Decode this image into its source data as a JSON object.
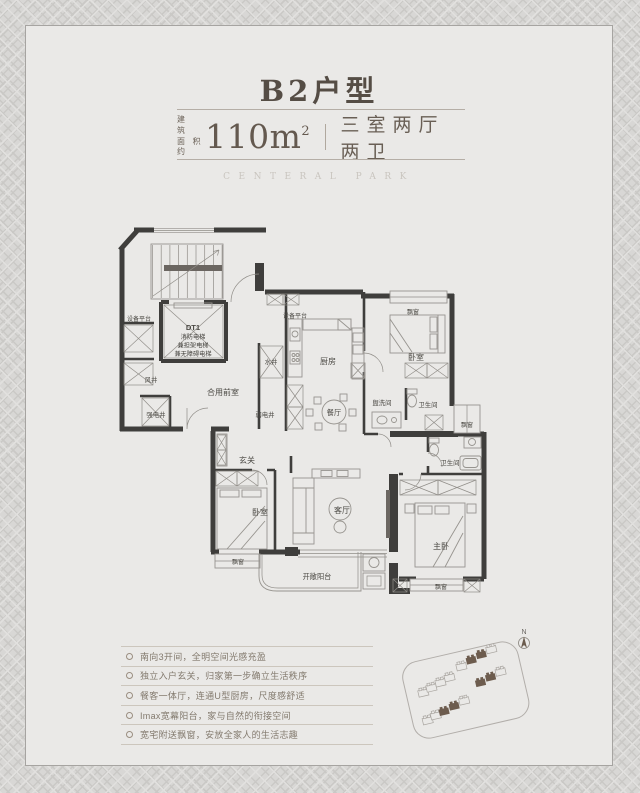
{
  "header": {
    "title": "B2户型",
    "area_label_line1": "建 筑",
    "area_label_line2": "面积约",
    "area_value": "110m",
    "area_unit_sup": "2",
    "layout_text": "三室两厅两卫",
    "watermark": "CENTERAL PARK"
  },
  "plan": {
    "labels": {
      "equip_platform_left": "设备平台",
      "elevator_code": "DT1",
      "elevator_line1": "消防电梯",
      "elevator_line2": "兼担架电梯",
      "elevator_line3": "兼无障碍电梯",
      "wind_shaft": "风井",
      "shared_lobby": "合用前室",
      "strong_elec_shaft": "强电井",
      "weak_elec_shaft": "弱电井",
      "water_shaft": "水井",
      "equip_platform_center": "设备平台",
      "kitchen": "厨房",
      "dining": "餐厅",
      "bedroom_top": "卧室",
      "bay_window_top": "飘窗",
      "washroom": "盥洗间",
      "bathroom_top": "卫生间",
      "bay_window_right": "飘窗",
      "bathroom_low": "卫生间",
      "entry": "玄关",
      "bedroom_left": "卧室",
      "living": "客厅",
      "master": "主卧",
      "bay_window_bottom_left": "飘窗",
      "bay_window_bottom_right": "飘窗",
      "balcony": "开敞阳台"
    }
  },
  "features": {
    "items": [
      "南向3开间，全明空间光感充盈",
      "独立入户玄关，归家第一步确立生活秩序",
      "餐客一体厅，连通U型厨房，尺度感舒适",
      "Imax宽幕阳台，家与自然的衔接空间",
      "宽宅附送飘窗，安放全家人的生活志趣"
    ]
  },
  "site_plan": {
    "north_label": "N"
  },
  "colors": {
    "card_bg": "#eae9e7",
    "title_text": "#554d45",
    "wall": "#3f3e3c",
    "dark_building": "#6d5c4e",
    "feature_text": "#837a6e"
  }
}
